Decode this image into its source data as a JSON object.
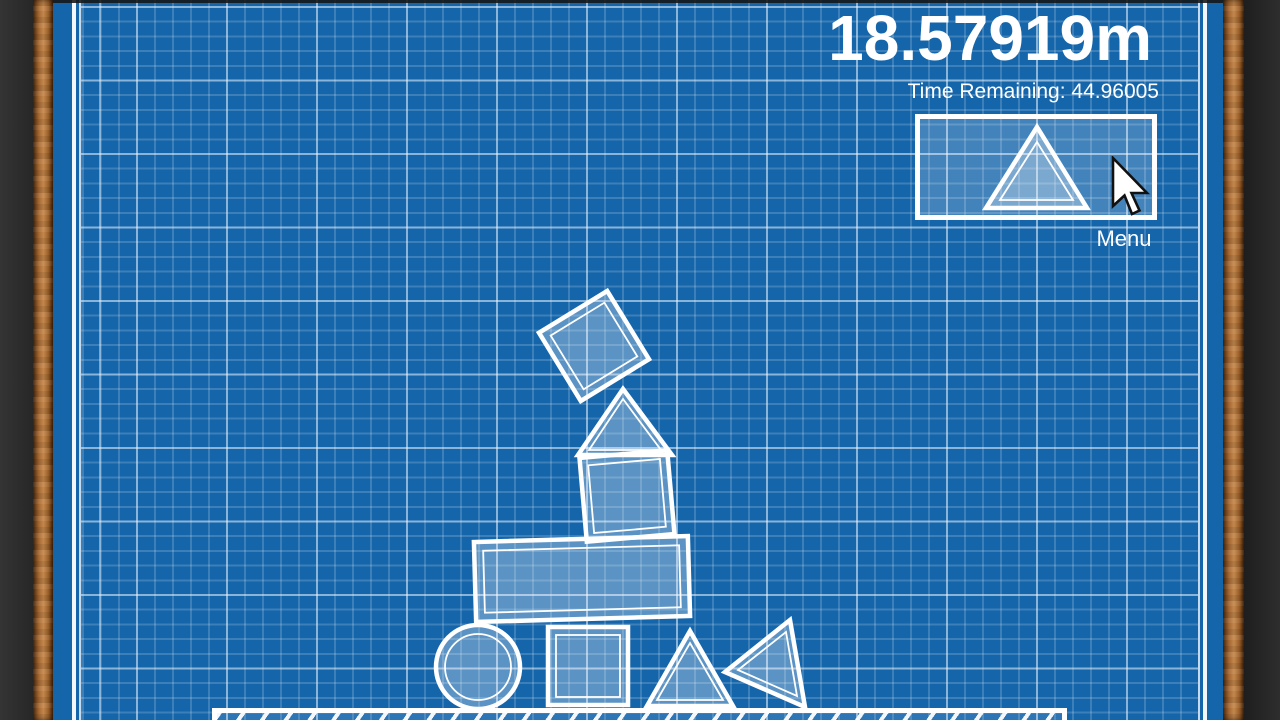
{
  "hud": {
    "score": "18.57919m",
    "time_remaining": "Time Remaining: 44.96005",
    "menu_label": "Menu"
  },
  "colors": {
    "blueprint_blue": "#1565ab",
    "grid_minor": "rgba(255,255,255,0.17)",
    "grid_major": "rgba(235,245,255,0.45)",
    "shape_fill": "rgba(255,255,255,0.30)",
    "outline_white": "#ffffff",
    "wood_light": "#c68a4e",
    "wood_dark": "#55300f",
    "side_panel_dark": "#2b2b2b"
  },
  "platform": {
    "x": 212,
    "y": 708,
    "width": 855,
    "height": 14
  },
  "cursor": {
    "x": 1111,
    "y": 156
  },
  "shapes": [
    {
      "name": "block-square-rotated",
      "transform": "translate(594,346) rotate(-31.5)",
      "outer": {
        "kind": "rect",
        "attrs": {
          "x": -40,
          "y": -40,
          "width": 80,
          "height": 80
        }
      },
      "inner": {
        "kind": "rect",
        "attrs": {
          "x": -31.5,
          "y": -31.5,
          "width": 63,
          "height": 63
        }
      }
    },
    {
      "name": "block-triangle-stack",
      "outer": {
        "kind": "polygon",
        "attrs": {
          "points": "623,389 672,455 578,455"
        }
      },
      "inner": {
        "kind": "polygon",
        "attrs": {
          "points": "623,399 661,450 589,450"
        }
      }
    },
    {
      "name": "block-square-stack",
      "transform": "translate(627,496) rotate(-5)",
      "outer": {
        "kind": "rect",
        "attrs": {
          "x": -44,
          "y": -42,
          "width": 88,
          "height": 84
        }
      },
      "inner": {
        "kind": "rect",
        "attrs": {
          "x": -36,
          "y": -34,
          "width": 72,
          "height": 68
        }
      }
    },
    {
      "name": "block-rectangle-wide",
      "transform": "translate(582,579) rotate(-1.6)",
      "outer": {
        "kind": "rect",
        "attrs": {
          "x": -107,
          "y": -40,
          "width": 214,
          "height": 80
        }
      },
      "inner": {
        "kind": "rect",
        "attrs": {
          "x": -98,
          "y": -31,
          "width": 196,
          "height": 62
        }
      }
    },
    {
      "name": "block-circle",
      "outer": {
        "kind": "circle",
        "attrs": {
          "cx": 478,
          "cy": 667,
          "r": 42
        }
      },
      "inner": {
        "kind": "circle",
        "attrs": {
          "cx": 478,
          "cy": 667,
          "r": 33
        }
      }
    },
    {
      "name": "block-square-ground",
      "outer": {
        "kind": "rect",
        "attrs": {
          "x": 548,
          "y": 627,
          "width": 80,
          "height": 78
        }
      },
      "inner": {
        "kind": "rect",
        "attrs": {
          "x": 556,
          "y": 635,
          "width": 64,
          "height": 62
        }
      }
    },
    {
      "name": "block-triangle-ground",
      "outer": {
        "kind": "polygon",
        "attrs": {
          "points": "690,631 733,706 647,706"
        }
      },
      "inner": {
        "kind": "polygon",
        "attrs": {
          "points": "690,643 723,700 657,700"
        }
      }
    },
    {
      "name": "block-triangle-tipped-left",
      "outer": {
        "kind": "polygon",
        "attrs": {
          "points": "725,672 790,620 805,707"
        }
      },
      "inner": {
        "kind": "polygon",
        "attrs": {
          "points": "738,670 786,632 797,696"
        }
      }
    },
    {
      "name": "preview-next-triangle",
      "outer": {
        "kind": "polygon",
        "attrs": {
          "points": "1037,127 1087,208 986,208"
        }
      },
      "inner": {
        "kind": "polygon",
        "attrs": {
          "points": "1037,142 1073,200 1000,200"
        }
      }
    }
  ]
}
